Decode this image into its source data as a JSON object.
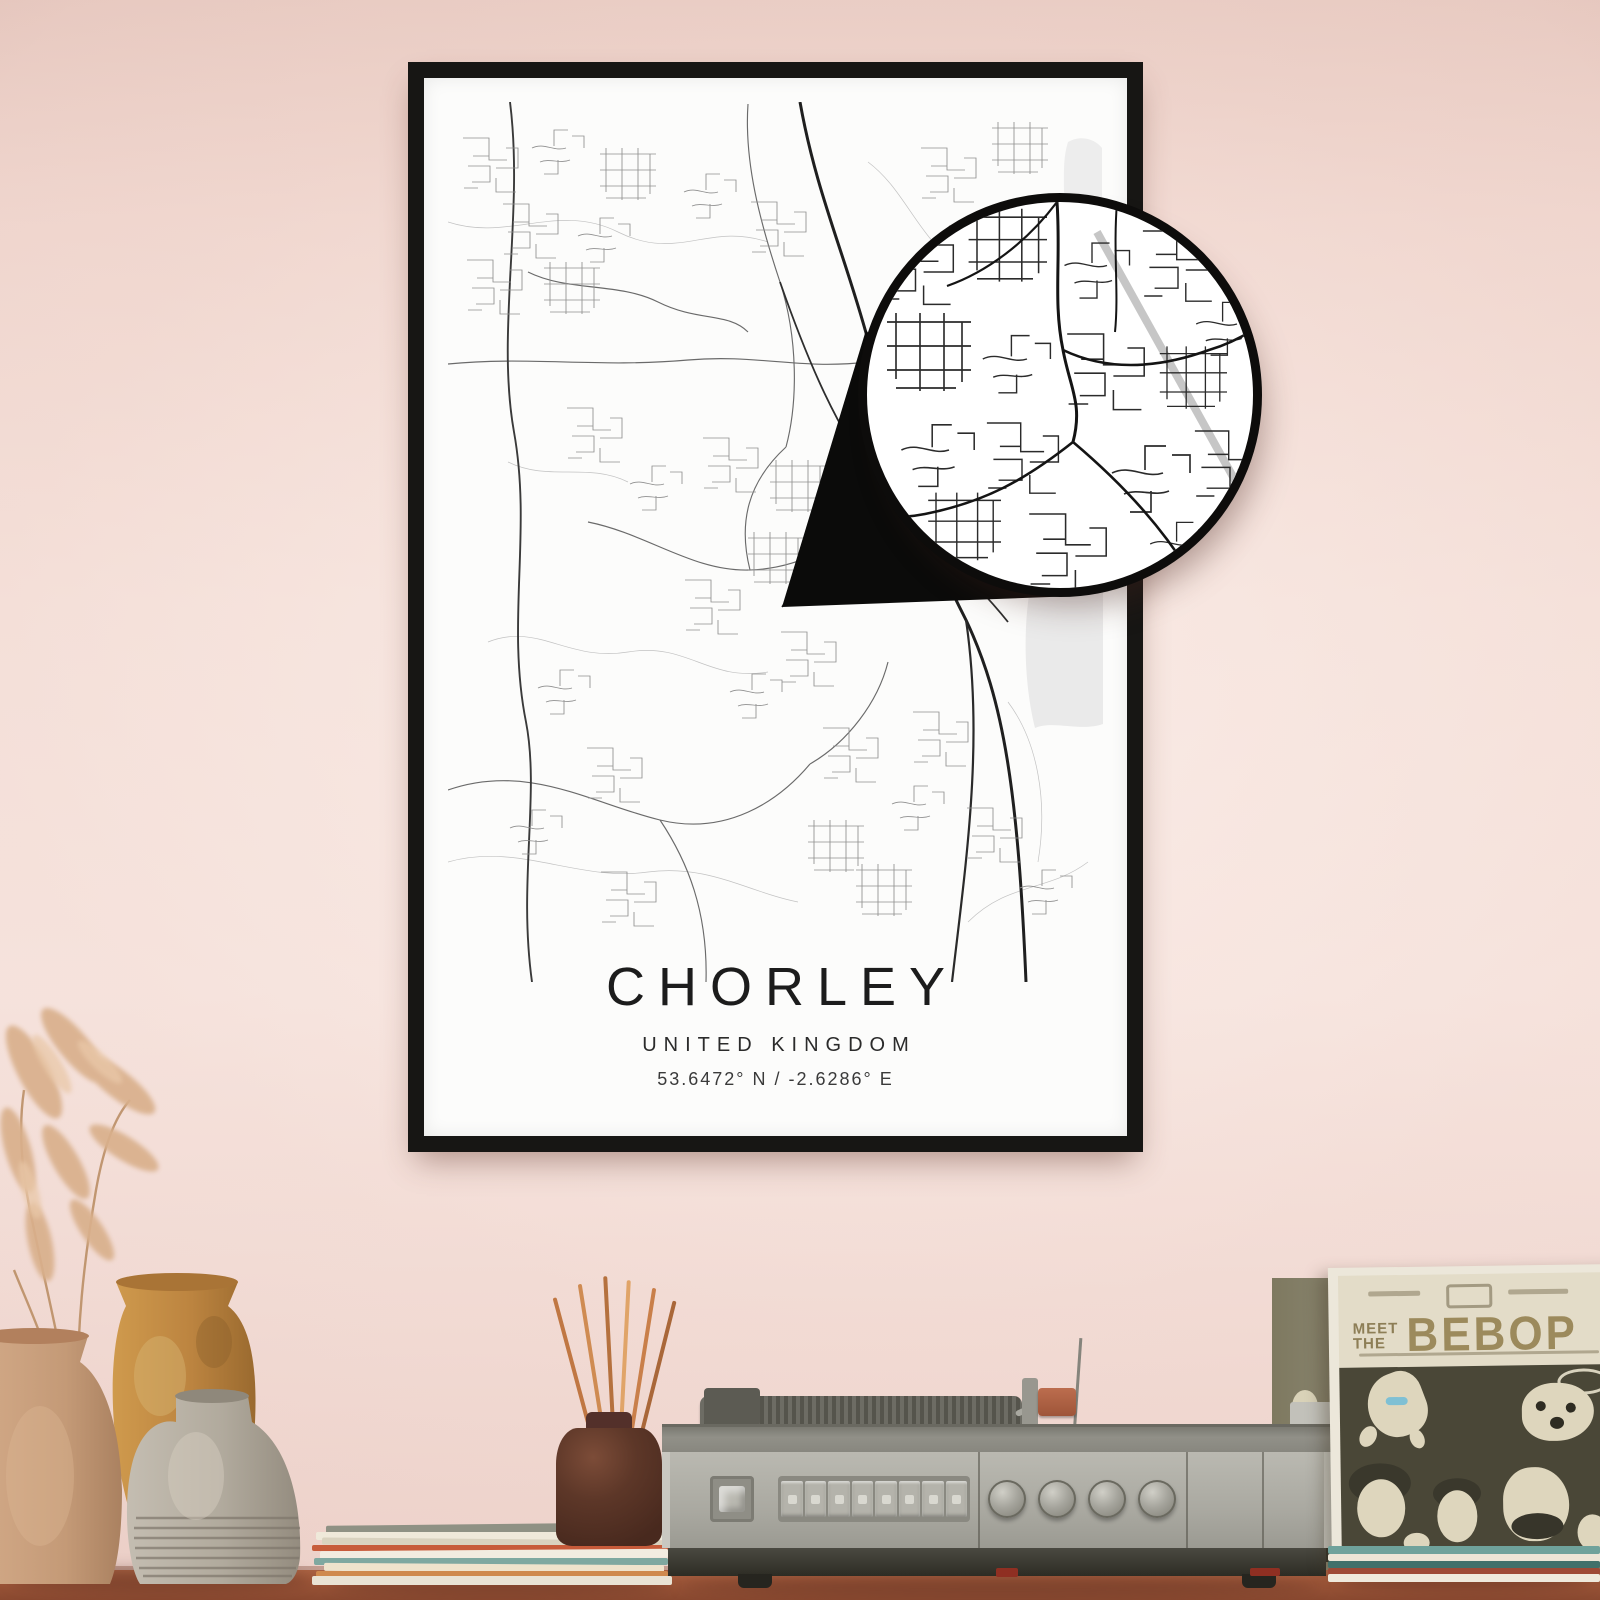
{
  "poster": {
    "title": "CHORLEY",
    "subtitle": "UNITED KINGDOM",
    "coordinates": "53.6472° N / -2.6286° E"
  },
  "record_sleeve": {
    "meet": "MEET",
    "the": "THE",
    "title": "BEBOP"
  },
  "colors": {
    "wall_pink": "#f2dbd4",
    "frame_black": "#171614",
    "map_ink": "#242424",
    "callout_black": "#0d0c0b",
    "table_terracotta": "#9c5538",
    "sleeve_olive": "#4a4737",
    "sleeve_title_gold": "#9c8a5c",
    "diffuser_brown": "#5d3728",
    "reed_orange": "#c9823f"
  }
}
